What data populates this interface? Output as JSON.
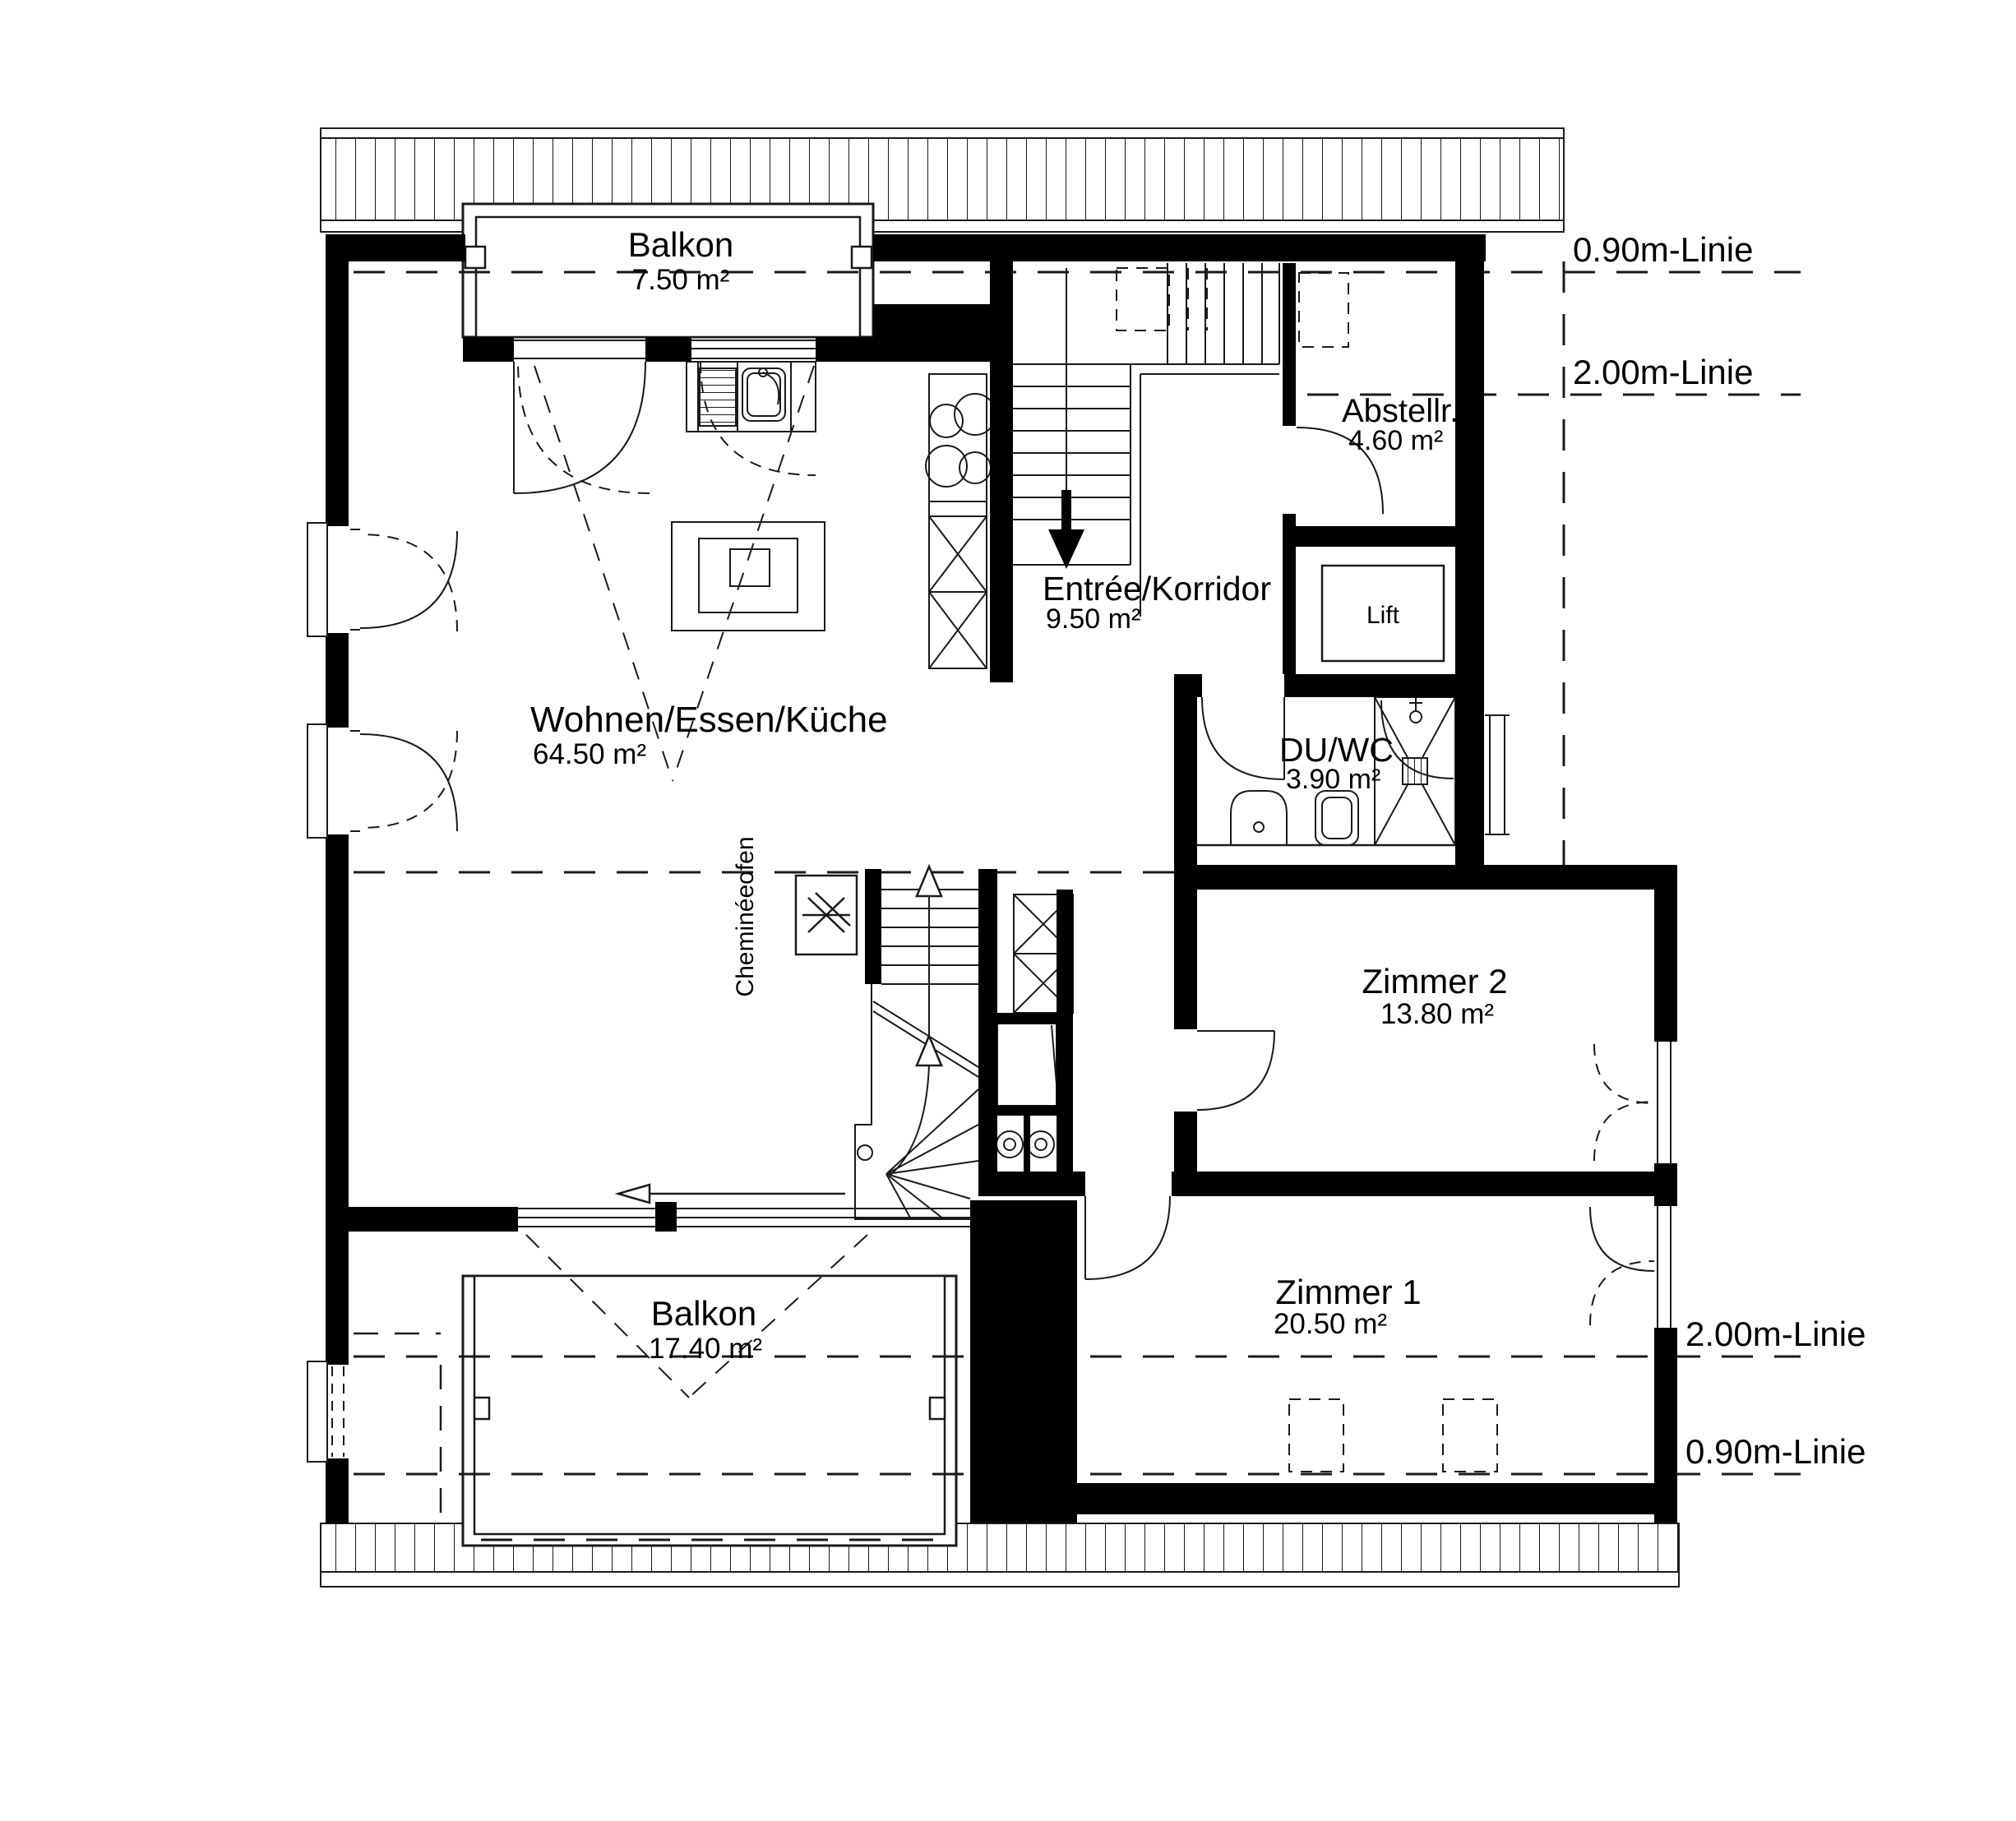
{
  "plan": {
    "title": "Attikageschoss Grundriss",
    "rooms": {
      "balkon_top": {
        "name": "Balkon",
        "area": "7.50 m²"
      },
      "wohnen": {
        "name": "Wohnen/Essen/Küche",
        "area": "64.50 m²"
      },
      "entree": {
        "name": "Entrée/Korridor",
        "area": "9.50 m²"
      },
      "abstellraum": {
        "name": "Abstellr.",
        "area": "4.60 m²"
      },
      "lift": {
        "name": "Lift"
      },
      "duwc": {
        "name": "DU/WC",
        "area": "3.90 m²"
      },
      "zimmer2": {
        "name": "Zimmer 2",
        "area": "13.80 m²"
      },
      "zimmer1": {
        "name": "Zimmer 1",
        "area": "20.50 m²"
      },
      "balkon_bottom": {
        "name": "Balkon",
        "area": "17.40 m²"
      },
      "cheminee": {
        "name": "Cheminéeofen"
      }
    },
    "annotations": {
      "line_090_top": "0.90m-Linie",
      "line_200_top": "2.00m-Linie",
      "line_200_bottom": "2.00m-Linie",
      "line_090_bottom": "0.90m-Linie"
    },
    "colors": {
      "wall": "#000000",
      "line": "#1a1a1a",
      "background": "#ffffff"
    }
  }
}
